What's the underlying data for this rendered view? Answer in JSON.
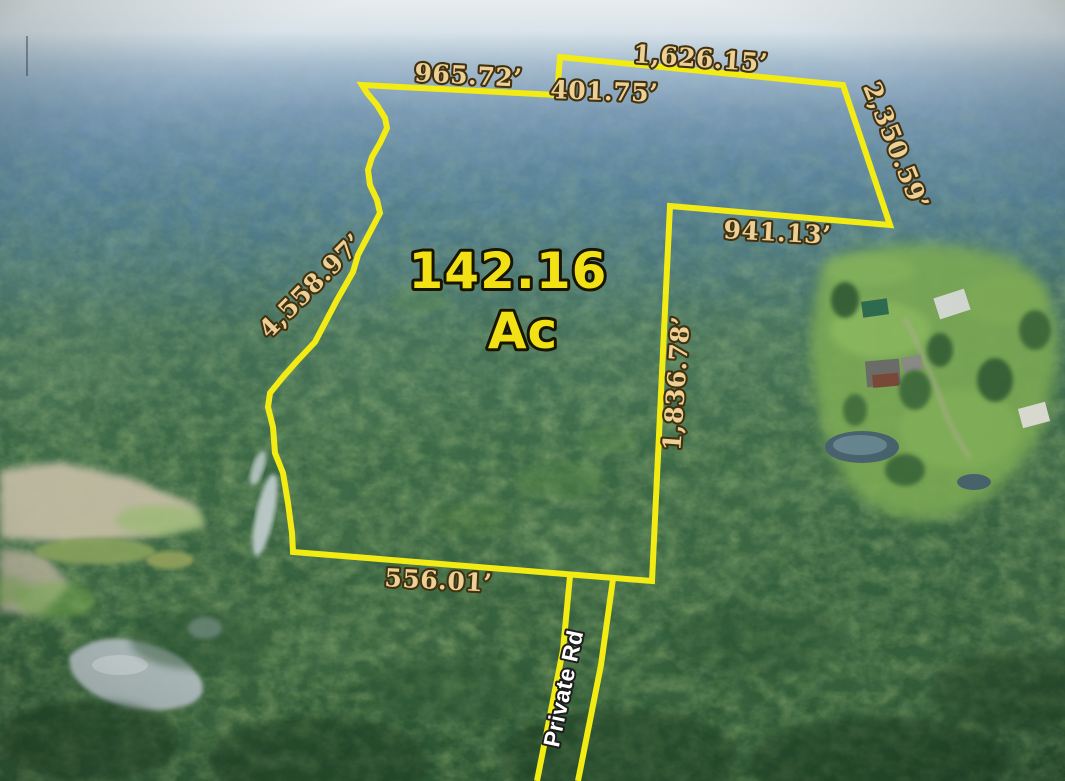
{
  "annotations": {
    "area": {
      "value": "142.16",
      "unit": "Ac"
    },
    "boundary_lengths": [
      {
        "side": "north-west",
        "label": "965.72’"
      },
      {
        "side": "north-notch",
        "label": "401.75’"
      },
      {
        "side": "north-east",
        "label": "1,626.15’"
      },
      {
        "side": "east-diagonal",
        "label": "2,350.59’"
      },
      {
        "side": "east-upper",
        "label": "941.13’"
      },
      {
        "side": "east-vertical",
        "label": "1,836.78’"
      },
      {
        "side": "south",
        "label": "556.01’"
      },
      {
        "side": "west-creek",
        "label": "4,558.97’"
      }
    ],
    "road_label": "Private Rd"
  },
  "colors": {
    "boundary_line": "#f2ec14",
    "dimension_text": "#ecd096",
    "dimension_outline": "#42310f",
    "area_text": "#f2e114",
    "area_outline": "#181400",
    "road_text": "#ffffff",
    "road_outline": "#1d1d1d"
  }
}
